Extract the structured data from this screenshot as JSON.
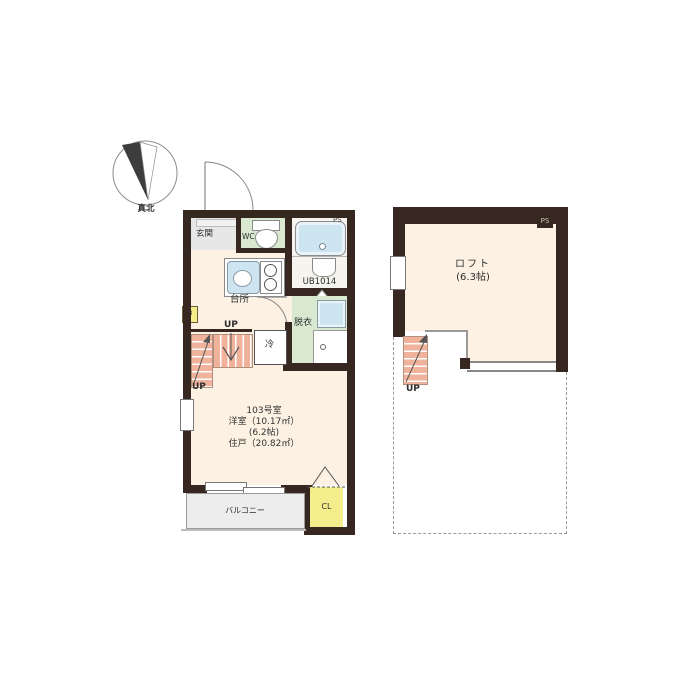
{
  "compass": {
    "label": "真北"
  },
  "floor1": {
    "entrance": "玄関",
    "wc": "WC",
    "bath": "UB1014",
    "ps": "PS",
    "kitchen": "台所",
    "shoe_box": "SB",
    "fridge": "冷",
    "dressing": "脱衣",
    "up_upper": "UP",
    "up_lower": "UP",
    "room_number": "103号室",
    "room_area": "洋室（10.17㎡）",
    "room_tatami": "(6.2帖)",
    "unit_area": "住戸（20.82㎡）",
    "balcony": "バルコニー",
    "closet": "CL"
  },
  "floor2": {
    "loft": "ロフト",
    "loft_size": "(6.3帖)",
    "ps": "PS",
    "up": "UP"
  },
  "colors": {
    "wall": "#362820",
    "floor": "#fcf1e2",
    "tile_green": "#d8e9d0",
    "water_blue": "#cde5f1",
    "stair_salmon": "#f1b29b",
    "accent_yellow": "#f3ee8b",
    "entry_grey": "#e7e7e7",
    "balcony_grey": "#ededed",
    "outline_grey": "#8a8a8a",
    "text_dark": "#333333",
    "ps_text": "#cfc6ba"
  }
}
